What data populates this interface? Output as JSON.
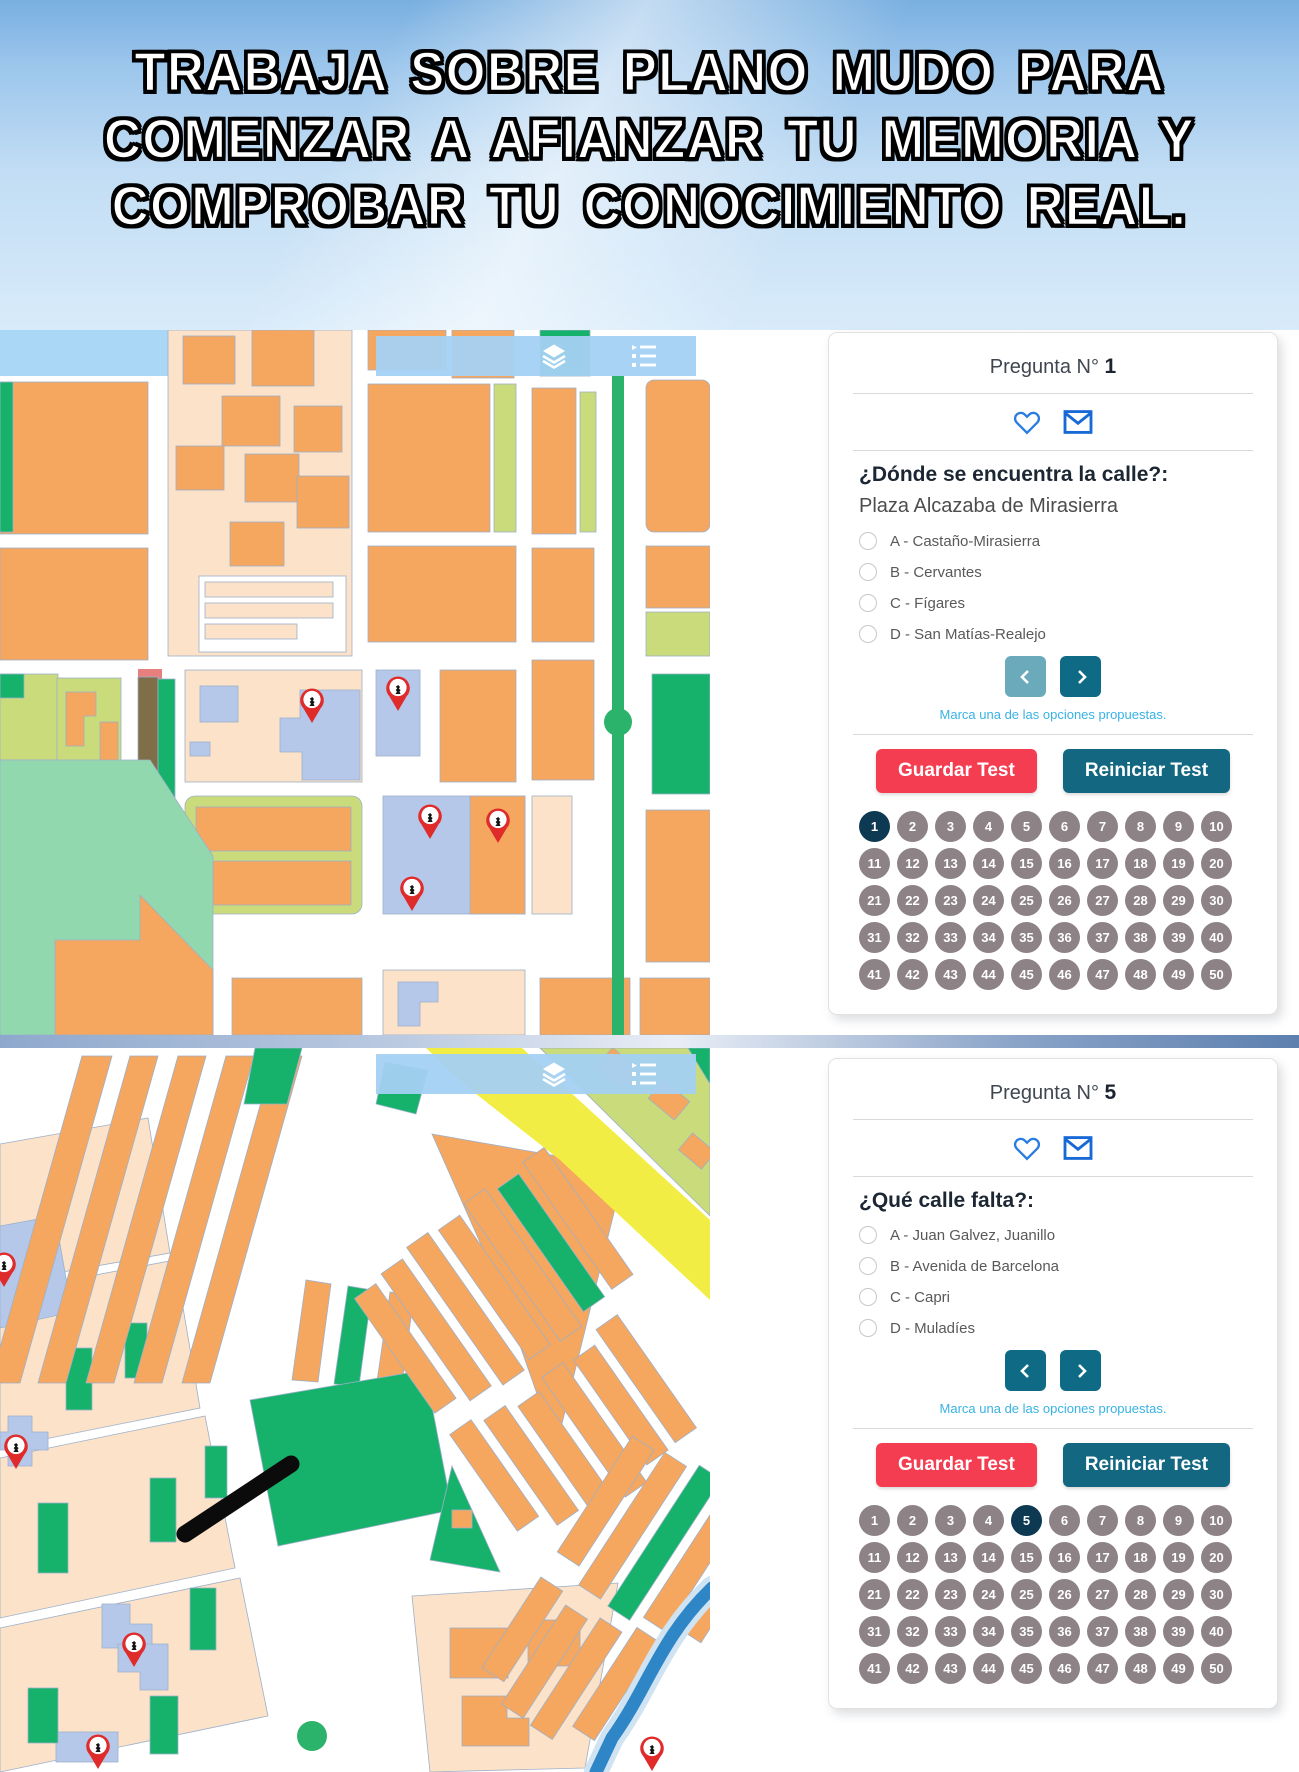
{
  "header": {
    "title_line1": "TRABAJA SOBRE PLANO MUDO PARA",
    "title_line2": "COMENZAR A AFIANZAR TU MEMORIA Y",
    "title_line3": "COMPROBAR TU CONOCIMIENTO REAL."
  },
  "map_toolbar": {
    "icons": [
      "layers-icon",
      "list-icon"
    ]
  },
  "quiz1": {
    "header_label": "Pregunta N°",
    "number": "1",
    "question": "¿Dónde se encuentra la calle?:",
    "street": "Plaza Alcazaba de Mirasierra",
    "options": [
      "A - Castaño-Mirasierra",
      "B - Cervantes",
      "C - Fígares",
      "D - San Matías-Realejo"
    ],
    "helper": "Marca una de las opciones propuestas.",
    "save_label": "Guardar Test",
    "reset_label": "Reiniciar Test",
    "prev_disabled": true,
    "grid": {
      "total": 50,
      "current": 1
    }
  },
  "quiz2": {
    "header_label": "Pregunta N°",
    "number": "5",
    "question": "¿Qué calle falta?:",
    "options": [
      "A - Juan Galvez, Juanillo",
      "B - Avenida de Barcelona",
      "C - Capri",
      "D - Muladíes"
    ],
    "helper": "Marca una de las opciones propuestas.",
    "save_label": "Guardar Test",
    "reset_label": "Reiniciar Test",
    "prev_disabled": false,
    "grid": {
      "total": 50,
      "current": 5
    }
  },
  "colors": {
    "accent_red": "#f53d52",
    "accent_teal": "#136781",
    "selected_circle": "#0d3a52",
    "idle_circle": "#8d8286",
    "helper_blue": "#38b2e4",
    "icon_blue": "#2a7de0",
    "map_orange": "#f5a75f",
    "map_peach": "#fbe2c8",
    "map_green": "#16b26c",
    "map_lime": "#c9db7a",
    "map_mint": "#92d8ae",
    "map_lavender": "#b5c8ea",
    "map_yellow": "#f2ed45",
    "map_river": "#2e86c6",
    "marker_red": "#e02b2b"
  }
}
